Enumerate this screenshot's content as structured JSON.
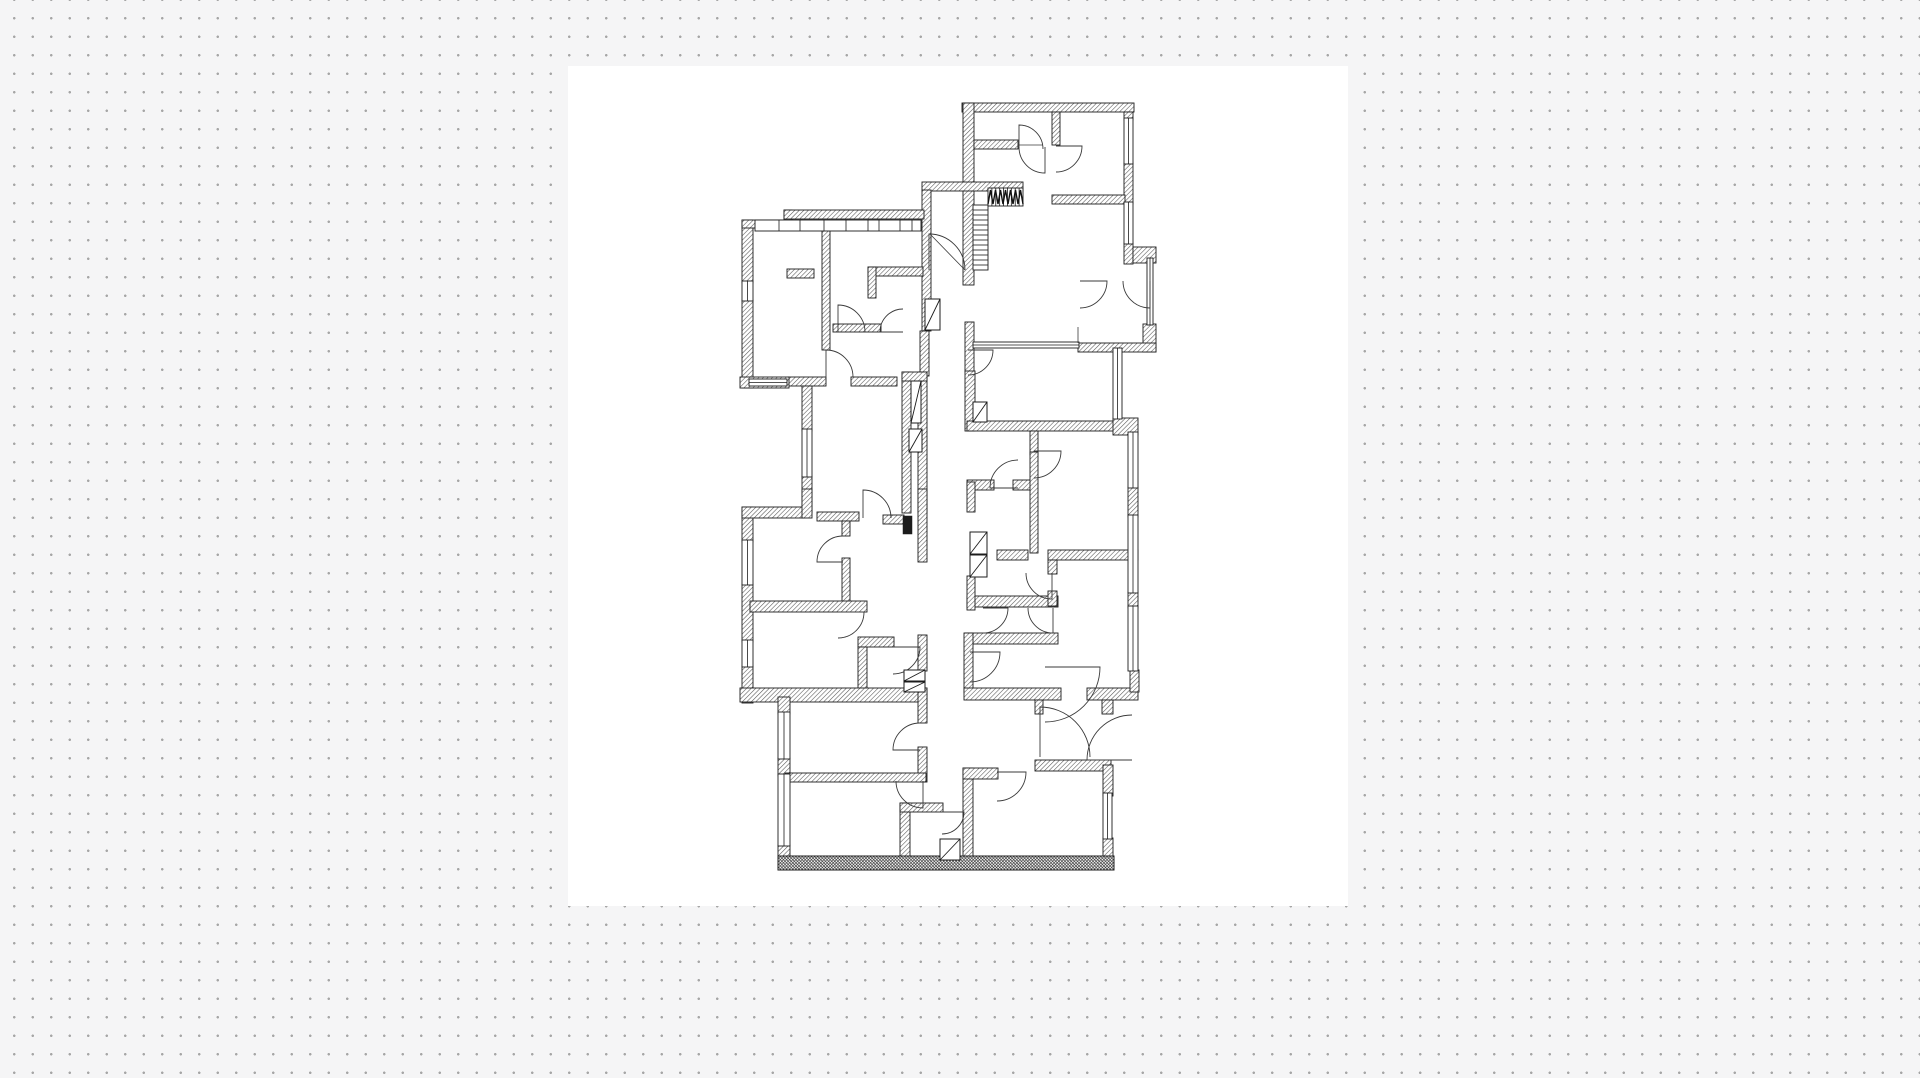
{
  "canvas": {
    "background_color": "#f5f5f6",
    "dot_color": "#a6a6a6",
    "dot_spacing": 18.5,
    "dot_size": 1.15,
    "width": 1920,
    "height": 1078
  },
  "artboard": {
    "x": 568,
    "y": 66,
    "w": 780,
    "h": 840,
    "background_color": "#ffffff"
  },
  "floor_plan": {
    "stroke_color": "#1c1c1c",
    "hatch_color": "#555555",
    "door_arc_color": "#3a3a3a",
    "walls": [
      [
        962,
        103,
        172,
        9
      ],
      [
        963,
        103,
        11,
        182
      ],
      [
        1052,
        112,
        8,
        33
      ],
      [
        974,
        140,
        44,
        9
      ],
      [
        1124,
        112,
        9,
        8
      ],
      [
        1124,
        163,
        9,
        41
      ],
      [
        1124,
        243,
        9,
        21
      ],
      [
        1133,
        247,
        23,
        16
      ],
      [
        1052,
        195,
        73,
        9
      ],
      [
        922,
        182,
        101,
        9
      ],
      [
        922,
        190,
        9,
        141
      ],
      [
        920,
        331,
        9,
        45
      ],
      [
        1143,
        324,
        13,
        28
      ],
      [
        1078,
        343,
        78,
        9
      ],
      [
        742,
        220,
        11,
        63
      ],
      [
        742,
        300,
        11,
        88
      ],
      [
        742,
        220,
        47,
        8
      ],
      [
        784,
        210,
        8,
        18
      ],
      [
        784,
        210,
        140,
        9
      ],
      [
        822,
        228,
        8,
        122
      ],
      [
        868,
        267,
        55,
        9
      ],
      [
        868,
        267,
        8,
        31
      ],
      [
        833,
        324,
        48,
        8
      ],
      [
        787,
        269,
        27,
        9
      ],
      [
        788,
        377,
        38,
        9
      ],
      [
        851,
        377,
        46,
        9
      ],
      [
        740,
        377,
        49,
        11
      ],
      [
        802,
        386,
        10,
        45
      ],
      [
        802,
        476,
        10,
        37
      ],
      [
        902,
        372,
        9,
        141
      ],
      [
        918,
        372,
        9,
        141
      ],
      [
        902,
        372,
        25,
        9
      ],
      [
        742,
        507,
        11,
        35
      ],
      [
        742,
        584,
        11,
        58
      ],
      [
        742,
        666,
        11,
        37
      ],
      [
        742,
        507,
        62,
        11
      ],
      [
        802,
        489,
        10,
        29
      ],
      [
        817,
        512,
        42,
        9
      ],
      [
        842,
        521,
        8,
        15
      ],
      [
        883,
        515,
        21,
        9
      ],
      [
        918,
        489,
        9,
        73
      ],
      [
        842,
        558,
        8,
        49
      ],
      [
        750,
        601,
        117,
        11
      ],
      [
        858,
        637,
        36,
        10
      ],
      [
        858,
        647,
        9,
        43
      ],
      [
        918,
        635,
        9,
        36
      ],
      [
        740,
        688,
        187,
        14
      ],
      [
        778,
        697,
        12,
        17
      ],
      [
        778,
        758,
        12,
        18
      ],
      [
        778,
        845,
        12,
        16
      ],
      [
        918,
        688,
        9,
        35
      ],
      [
        918,
        747,
        9,
        35
      ],
      [
        785,
        773,
        141,
        9
      ],
      [
        900,
        803,
        10,
        57
      ],
      [
        900,
        803,
        43,
        9
      ],
      [
        963,
        768,
        10,
        91
      ],
      [
        963,
        768,
        35,
        11
      ],
      [
        1035,
        760,
        76,
        11
      ],
      [
        1103,
        765,
        10,
        31
      ],
      [
        1103,
        838,
        10,
        22
      ],
      [
        965,
        633,
        93,
        11
      ],
      [
        964,
        633,
        9,
        60
      ],
      [
        964,
        688,
        97,
        12
      ],
      [
        1035,
        700,
        8,
        14
      ],
      [
        1087,
        688,
        51,
        12
      ],
      [
        1102,
        700,
        11,
        14
      ],
      [
        1130,
        670,
        9,
        22
      ],
      [
        965,
        322,
        9,
        50
      ],
      [
        965,
        371,
        10,
        60
      ],
      [
        967,
        421,
        147,
        10
      ],
      [
        1030,
        431,
        8,
        24
      ],
      [
        1113,
        418,
        25,
        17
      ],
      [
        967,
        480,
        27,
        10
      ],
      [
        1013,
        480,
        18,
        10
      ],
      [
        1030,
        452,
        8,
        101
      ],
      [
        997,
        550,
        31,
        10
      ],
      [
        1048,
        550,
        90,
        10
      ],
      [
        1048,
        560,
        9,
        14
      ],
      [
        967,
        596,
        91,
        11
      ],
      [
        1048,
        591,
        9,
        15
      ],
      [
        967,
        482,
        8,
        30
      ],
      [
        967,
        576,
        8,
        34
      ],
      [
        1128,
        487,
        10,
        30
      ],
      [
        1128,
        592,
        10,
        16
      ]
    ],
    "dense_walls": [
      [
        778,
        856,
        336,
        14
      ]
    ],
    "solid_walls": [
      [
        903,
        516,
        9,
        18
      ]
    ],
    "windows": [
      [
        1124,
        118,
        9,
        46
      ],
      [
        1124,
        202,
        9,
        42
      ],
      [
        742,
        281,
        11,
        20
      ],
      [
        749,
        379,
        38,
        7
      ],
      [
        802,
        429,
        10,
        48
      ],
      [
        742,
        540,
        11,
        45
      ],
      [
        742,
        640,
        11,
        27
      ],
      [
        778,
        712,
        12,
        47
      ],
      [
        778,
        774,
        12,
        72
      ],
      [
        973,
        342,
        106,
        6
      ],
      [
        1147,
        258,
        6,
        67
      ],
      [
        1113,
        348,
        9,
        71
      ],
      [
        1128,
        432,
        10,
        56
      ],
      [
        1128,
        515,
        10,
        78
      ],
      [
        1128,
        606,
        10,
        65
      ],
      [
        1103,
        793,
        9,
        46
      ]
    ],
    "doors": [
      [
        1019,
        149,
        24,
        270,
        360
      ],
      [
        1056,
        146,
        26,
        0,
        90
      ],
      [
        1045,
        147,
        26,
        90,
        180
      ],
      [
        1080,
        281,
        27,
        0,
        90
      ],
      [
        1150,
        281,
        27,
        90,
        180
      ],
      [
        929,
        270,
        36,
        270,
        360
      ],
      [
        826,
        377,
        27,
        270,
        360
      ],
      [
        838,
        332,
        27,
        270,
        360
      ],
      [
        903,
        332,
        23,
        180,
        270
      ],
      [
        968,
        350,
        25,
        0,
        90
      ],
      [
        863,
        518,
        28,
        270,
        360
      ],
      [
        843,
        562,
        26,
        180,
        270
      ],
      [
        838,
        612,
        26,
        0,
        90
      ],
      [
        893,
        647,
        27,
        0,
        90
      ],
      [
        920,
        750,
        27,
        180,
        270
      ],
      [
        923,
        781,
        27,
        90,
        180
      ],
      [
        942,
        812,
        22,
        0,
        90
      ],
      [
        997,
        772,
        29,
        0,
        90
      ],
      [
        1018,
        488,
        28,
        180,
        270
      ],
      [
        1034,
        451,
        27,
        0,
        90
      ],
      [
        1052,
        573,
        26,
        90,
        180
      ],
      [
        983,
        608,
        25,
        0,
        90
      ],
      [
        1053,
        608,
        25,
        90,
        180
      ],
      [
        970,
        652,
        30,
        0,
        90
      ],
      [
        1045,
        667,
        55,
        0,
        90
      ],
      [
        1040,
        757,
        50,
        270,
        360
      ],
      [
        1132,
        760,
        45,
        180,
        270
      ]
    ],
    "stairs": {
      "flight_vertical": {
        "x": 973,
        "y": 205,
        "w": 15,
        "h": 65,
        "steps": 13
      },
      "flight_horizontal": {
        "x": 988,
        "y": 188,
        "w": 35,
        "h": 18,
        "steps": 9
      },
      "break_line": {
        "x": 988,
        "y": 188,
        "w": 35,
        "h": 16,
        "teeth": 7
      }
    },
    "shafts": [
      [
        973,
        402,
        14,
        20
      ],
      [
        970,
        532,
        17,
        22
      ],
      [
        970,
        555,
        17,
        22
      ],
      [
        911,
        381,
        10,
        42
      ],
      [
        909,
        429,
        13,
        23
      ],
      [
        904,
        670,
        21,
        11
      ],
      [
        904,
        682,
        21,
        10
      ],
      [
        940,
        839,
        20,
        21
      ],
      [
        925,
        299,
        15,
        31
      ]
    ],
    "cabinet_row": {
      "x": 755,
      "y": 220,
      "w": 166,
      "h": 11,
      "dividers": [
        779,
        800,
        824,
        846,
        868,
        879,
        900,
        912
      ]
    },
    "thin_lines": [
      [
        1018,
        145,
        1043,
        145
      ],
      [
        1078,
        327,
        1078,
        343
      ],
      [
        930,
        234,
        965,
        270
      ]
    ]
  }
}
